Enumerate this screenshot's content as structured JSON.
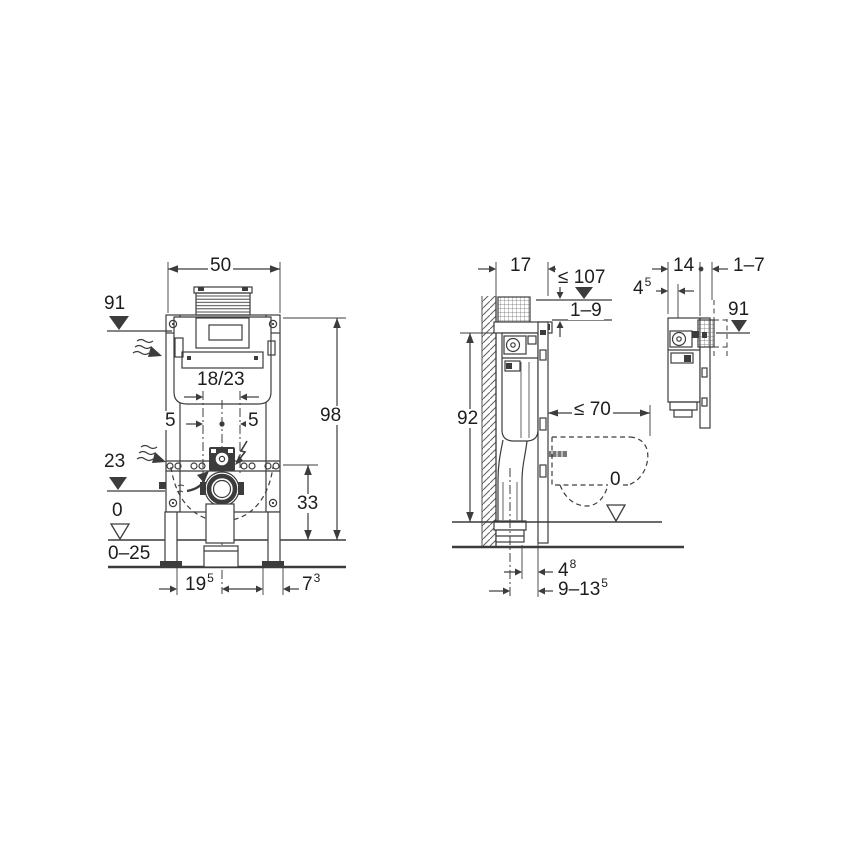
{
  "drawing_title": "wall-frame installation dimensions",
  "colors": {
    "line": "#3c3c3c",
    "text": "#1d1d1d",
    "background": "#ffffff",
    "rod_fill": "#777777"
  },
  "icons": {
    "filled_level_marker": "▼",
    "open_level_marker": "▽",
    "wavy_arrow": "≈→",
    "zigzag_arrow": "↯",
    "center_dot": "•"
  },
  "front_view": {
    "frame_width": {
      "base": "50"
    },
    "frame_height": {
      "base": "98"
    },
    "plate_height": {
      "base": "91"
    },
    "outlet_height": {
      "base": "23"
    },
    "floor_zero": {
      "base": "0"
    },
    "floor_range": {
      "base": "0–25"
    },
    "outlet_offset": {
      "base": "33"
    },
    "bolt_spacing": {
      "base": "18/23"
    },
    "supply_left": {
      "base": "5"
    },
    "supply_right": {
      "base": "5"
    },
    "foot_left": {
      "base": "19",
      "sup": "5"
    },
    "foot_right": {
      "base": "7",
      "sup": "3"
    }
  },
  "side_view": {
    "depth": {
      "base": "17"
    },
    "max_height": {
      "base": "≤ 107"
    },
    "adjust_range": {
      "base": "1–9"
    },
    "frame_height": {
      "base": "92"
    },
    "bowl_projection": {
      "base": "≤ 70"
    },
    "floor_zero": {
      "base": "0"
    },
    "pipe_offset": {
      "base": "4",
      "sup": "8"
    },
    "pipe_range": {
      "base": "9–13",
      "sup": "5"
    }
  },
  "detail_view": {
    "cistern_depth": {
      "base": "14"
    },
    "wall_finish_range": {
      "base": "1–7"
    },
    "plate_pocket_depth": {
      "base": "4",
      "sup": "5"
    },
    "plate_height": {
      "base": "91"
    }
  }
}
